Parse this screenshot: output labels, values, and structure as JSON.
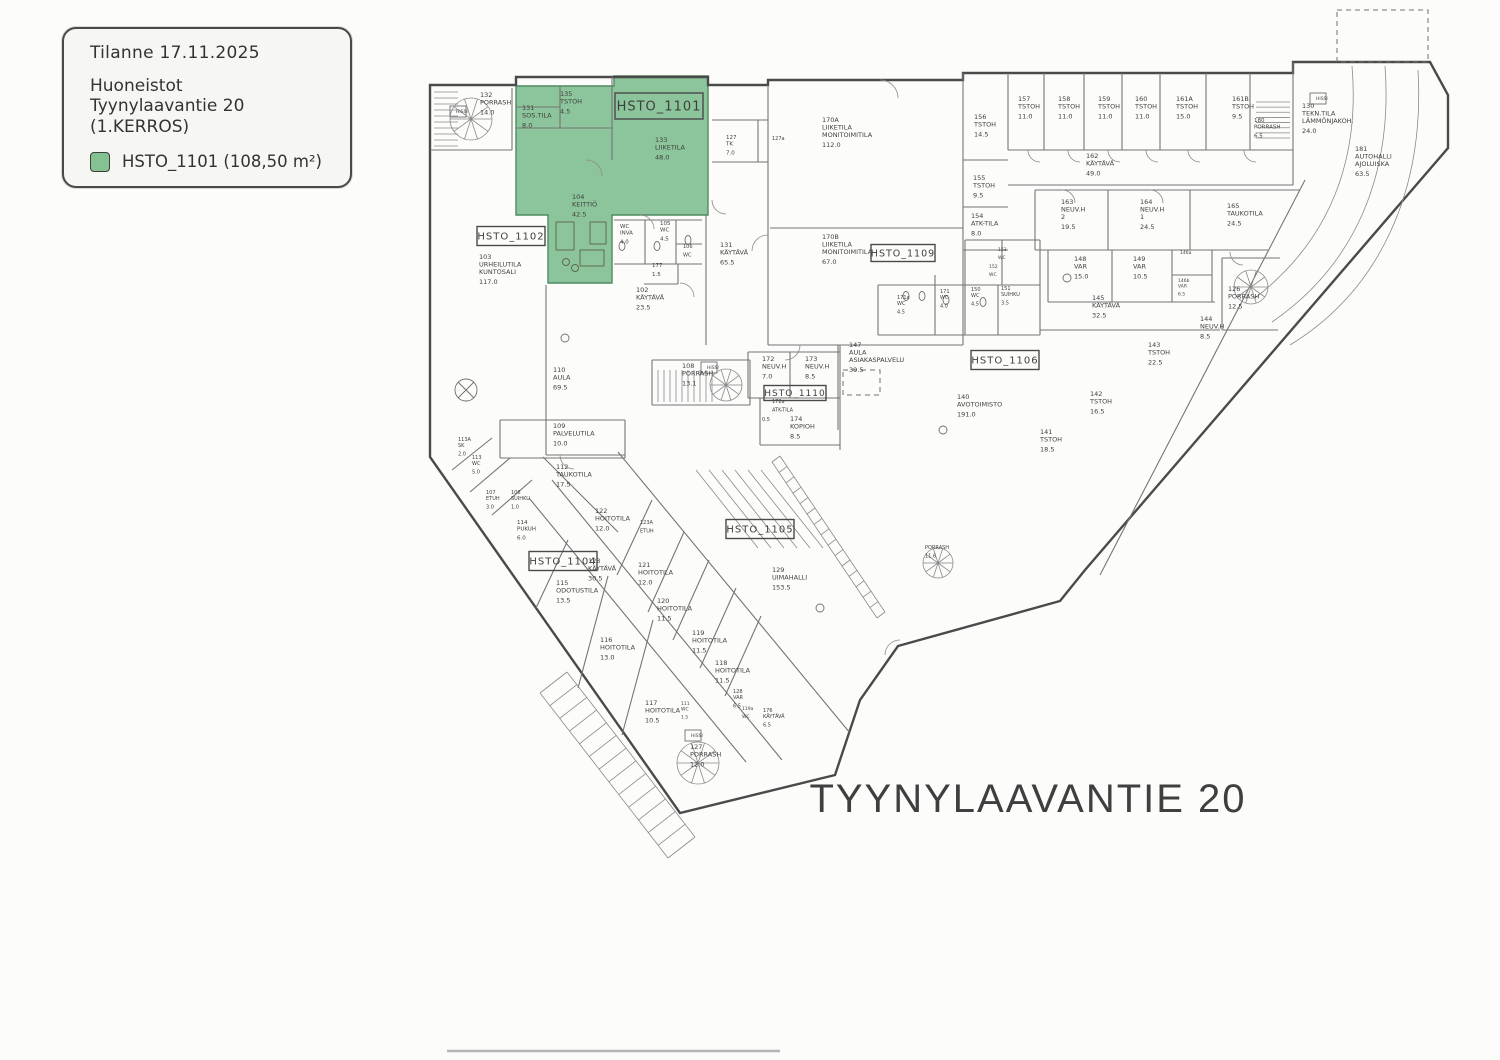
{
  "legend": {
    "line1": "Tilanne 17.11.2025",
    "line2": "Huoneistot",
    "line3": "Tyynylaavantie 20",
    "line4": "(1.KERROS)",
    "swatch_color": "#85c292",
    "swatch_label": "HSTO_1101 (108,50 m²)"
  },
  "street_label": "TYYNYLAAVANTIE 20",
  "highlight": {
    "color": "#8cc59b",
    "border": "#4f8a62",
    "label": "HSTO_1101"
  },
  "apartment_boxes": [
    {
      "label": "HSTO_1101",
      "x": 659,
      "y": 106,
      "w": 88,
      "h": 26,
      "fs": 13
    },
    {
      "label": "HSTO_1102",
      "x": 511,
      "y": 236,
      "w": 68,
      "h": 19,
      "fs": 10
    },
    {
      "label": "HSTO_1104",
      "x": 563,
      "y": 561,
      "w": 68,
      "h": 19,
      "fs": 10
    },
    {
      "label": "HSTO_1105",
      "x": 760,
      "y": 529,
      "w": 68,
      "h": 19,
      "fs": 10
    },
    {
      "label": "HSTO_1106",
      "x": 1005,
      "y": 360,
      "w": 68,
      "h": 19,
      "fs": 10
    },
    {
      "label": "HSTO_1109",
      "x": 903,
      "y": 253,
      "w": 64,
      "h": 17,
      "fs": 9.5
    },
    {
      "label": "HSTO_1110",
      "x": 795,
      "y": 393,
      "w": 62,
      "h": 15,
      "fs": 9
    }
  ],
  "rooms": [
    {
      "l": [
        "132",
        "PORRASH",
        "14.0"
      ],
      "x": 480,
      "y": 97
    },
    {
      "l": [
        "HISSI"
      ],
      "x": 456,
      "y": 113,
      "s": 4.5
    },
    {
      "l": [
        "135",
        "TSTOH",
        "4.5"
      ],
      "x": 560,
      "y": 96
    },
    {
      "l": [
        "131",
        "SOS.TILA",
        "8.0"
      ],
      "x": 522,
      "y": 110
    },
    {
      "l": [
        "133",
        "LIIKETILA",
        "48.0"
      ],
      "x": 655,
      "y": 142
    },
    {
      "l": [
        "104",
        "KEITTIÖ",
        "42.5"
      ],
      "x": 572,
      "y": 199
    },
    {
      "l": [
        "WC",
        "INVA",
        "4.0"
      ],
      "x": 620,
      "y": 228,
      "s": 5.5
    },
    {
      "l": [
        "105",
        "WC",
        "4.5"
      ],
      "x": 660,
      "y": 225,
      "s": 5.5
    },
    {
      "l": [
        "106",
        "WC"
      ],
      "x": 683,
      "y": 248,
      "s": 5
    },
    {
      "l": [
        "177",
        "1.5"
      ],
      "x": 652,
      "y": 267,
      "s": 5.5
    },
    {
      "l": [
        "102",
        "KÄYTÄVÄ",
        "23.5"
      ],
      "x": 636,
      "y": 292
    },
    {
      "l": [
        "131",
        "KÄYTÄVÄ",
        "65.5"
      ],
      "x": 720,
      "y": 247
    },
    {
      "l": [
        "127",
        "TK",
        "7.0"
      ],
      "x": 726,
      "y": 139,
      "s": 5.5
    },
    {
      "l": [
        "127a"
      ],
      "x": 772,
      "y": 140,
      "s": 5
    },
    {
      "l": [
        "103",
        "URHEILUTILA",
        "KUNTOSALI",
        "117.0"
      ],
      "x": 479,
      "y": 259
    },
    {
      "l": [
        "170A",
        "LIIKETILA",
        "MONITOIMITILA",
        "112.0"
      ],
      "x": 822,
      "y": 122
    },
    {
      "l": [
        "170B",
        "LIIKETILA",
        "MONITOIMITILA",
        "67.0"
      ],
      "x": 822,
      "y": 239
    },
    {
      "l": [
        "156",
        "TSTOH",
        "14.5"
      ],
      "x": 974,
      "y": 119
    },
    {
      "l": [
        "155",
        "TSTOH",
        "9.5"
      ],
      "x": 973,
      "y": 180
    },
    {
      "l": [
        "154",
        "ATK-TILA",
        "8.0"
      ],
      "x": 971,
      "y": 218
    },
    {
      "l": [
        "157",
        "TSTOH",
        "11.0"
      ],
      "x": 1018,
      "y": 101
    },
    {
      "l": [
        "158",
        "TSTOH",
        "11.0"
      ],
      "x": 1058,
      "y": 101
    },
    {
      "l": [
        "159",
        "TSTOH",
        "11.0"
      ],
      "x": 1098,
      "y": 101
    },
    {
      "l": [
        "160",
        "TSTOH",
        "11.0"
      ],
      "x": 1135,
      "y": 101
    },
    {
      "l": [
        "161A",
        "TSTOH",
        "15.0"
      ],
      "x": 1176,
      "y": 101
    },
    {
      "l": [
        "161B",
        "TSTOH",
        "9.5"
      ],
      "x": 1232,
      "y": 101
    },
    {
      "l": [
        "180",
        "PORRASH",
        "6.5"
      ],
      "x": 1254,
      "y": 122,
      "s": 5.5
    },
    {
      "l": [
        "HISSI"
      ],
      "x": 1316,
      "y": 100,
      "s": 4.5
    },
    {
      "l": [
        "162",
        "KÄYTÄVÄ",
        "49.0"
      ],
      "x": 1086,
      "y": 158
    },
    {
      "l": [
        "130",
        "TEKN.TILA",
        "LÄMMÖNJAKOH.",
        "24.0"
      ],
      "x": 1302,
      "y": 108
    },
    {
      "l": [
        "181",
        "AUTOHALLI",
        "AJOLUISKA",
        "63.5"
      ],
      "x": 1355,
      "y": 151
    },
    {
      "l": [
        "163",
        "NEUV.H",
        "2",
        "19.5"
      ],
      "x": 1061,
      "y": 204
    },
    {
      "l": [
        "164",
        "NEUV.H",
        "1",
        "24.5"
      ],
      "x": 1140,
      "y": 204
    },
    {
      "l": [
        "165",
        "TAUKOTILA",
        "24.5"
      ],
      "x": 1227,
      "y": 208
    },
    {
      "l": [
        "148",
        "VAR",
        "15.0"
      ],
      "x": 1074,
      "y": 261
    },
    {
      "l": [
        "149",
        "VAR",
        "10.5"
      ],
      "x": 1133,
      "y": 261
    },
    {
      "l": [
        "146a"
      ],
      "x": 1180,
      "y": 254,
      "s": 4.5
    },
    {
      "l": [
        "146b",
        "VAR",
        "6.5"
      ],
      "x": 1178,
      "y": 282,
      "s": 4.5
    },
    {
      "l": [
        "145",
        "KÄYTÄVÄ",
        "32.5"
      ],
      "x": 1092,
      "y": 300
    },
    {
      "l": [
        "126",
        "PORRASH",
        "12.5"
      ],
      "x": 1228,
      "y": 291
    },
    {
      "l": [
        "171a",
        "WC",
        "4.5"
      ],
      "x": 897,
      "y": 299,
      "s": 5
    },
    {
      "l": [
        "171",
        "WC",
        "4.0"
      ],
      "x": 940,
      "y": 293,
      "s": 5
    },
    {
      "l": [
        "150",
        "WC",
        "4.5"
      ],
      "x": 971,
      "y": 291,
      "s": 5
    },
    {
      "l": [
        "151",
        "SUIHKU",
        "3.5"
      ],
      "x": 1001,
      "y": 290,
      "s": 5
    },
    {
      "l": [
        "152",
        "WC"
      ],
      "x": 989,
      "y": 268,
      "s": 4.5
    },
    {
      "l": [
        "153",
        "WC"
      ],
      "x": 998,
      "y": 251,
      "s": 4.5
    },
    {
      "l": [
        "147",
        "AULA",
        "ASIAKASPALVELU",
        "39.5"
      ],
      "x": 849,
      "y": 347
    },
    {
      "l": [
        "108",
        "PORRASH",
        "13.1"
      ],
      "x": 682,
      "y": 368
    },
    {
      "l": [
        "HISSI"
      ],
      "x": 707,
      "y": 369,
      "s": 4.5
    },
    {
      "l": [
        "172",
        "NEUV.H",
        "7.0"
      ],
      "x": 762,
      "y": 361
    },
    {
      "l": [
        "173",
        "NEUV.H",
        "8.5"
      ],
      "x": 805,
      "y": 361
    },
    {
      "l": [
        "172a",
        "ATK-TILA"
      ],
      "x": 772,
      "y": 403,
      "s": 5
    },
    {
      "l": [
        "0.5"
      ],
      "x": 762,
      "y": 421,
      "s": 5
    },
    {
      "l": [
        "174",
        "KOPIOH",
        "8.5"
      ],
      "x": 790,
      "y": 421
    },
    {
      "l": [
        "110",
        "AULA",
        "69.5"
      ],
      "x": 553,
      "y": 372
    },
    {
      "l": [
        "109",
        "PALVELUTILA",
        "10.0"
      ],
      "x": 553,
      "y": 428
    },
    {
      "l": [
        "140",
        "AVOTOIMISTO",
        "191.0"
      ],
      "x": 957,
      "y": 399
    },
    {
      "l": [
        "141",
        "TSTOH",
        "18.5"
      ],
      "x": 1040,
      "y": 434
    },
    {
      "l": [
        "142",
        "TSTOH",
        "16.5"
      ],
      "x": 1090,
      "y": 396
    },
    {
      "l": [
        "143",
        "TSTOH",
        "22.5"
      ],
      "x": 1148,
      "y": 347
    },
    {
      "l": [
        "144",
        "NEUV.H",
        "8.5"
      ],
      "x": 1200,
      "y": 321
    },
    {
      "l": [
        "129",
        "UIMAHALLI",
        "153.5"
      ],
      "x": 772,
      "y": 572
    },
    {
      "l": [
        "PORRASH",
        "11.6"
      ],
      "x": 925,
      "y": 549,
      "s": 5
    },
    {
      "l": [
        "113A",
        "SK",
        "2.0"
      ],
      "x": 458,
      "y": 441,
      "s": 5
    },
    {
      "l": [
        "113",
        "WC",
        "5.0"
      ],
      "x": 472,
      "y": 459,
      "s": 5
    },
    {
      "l": [
        "107",
        "ETUH",
        "3.0"
      ],
      "x": 486,
      "y": 494,
      "s": 5
    },
    {
      "l": [
        "106",
        "SUIHKU",
        "1.0"
      ],
      "x": 511,
      "y": 494,
      "s": 5
    },
    {
      "l": [
        "114",
        "PUKUH",
        "6.0"
      ],
      "x": 517,
      "y": 524,
      "s": 5.5
    },
    {
      "l": [
        "112",
        "TAUKOTILA",
        "17.5"
      ],
      "x": 556,
      "y": 469
    },
    {
      "l": [
        "122",
        "HOITOTILA",
        "12.0"
      ],
      "x": 595,
      "y": 513
    },
    {
      "l": [
        "123A",
        "ETUH"
      ],
      "x": 640,
      "y": 524,
      "s": 5
    },
    {
      "l": [
        "121",
        "HOITOTILA",
        "12.0"
      ],
      "x": 638,
      "y": 567
    },
    {
      "l": [
        "120",
        "HOITOTILA",
        "11.5"
      ],
      "x": 657,
      "y": 603
    },
    {
      "l": [
        "115",
        "ODOTUSTILA",
        "13.5"
      ],
      "x": 556,
      "y": 585
    },
    {
      "l": [
        "128",
        "KÄYTÄVÄ",
        "30.5"
      ],
      "x": 588,
      "y": 563
    },
    {
      "l": [
        "116",
        "HOITOTILA",
        "13.0"
      ],
      "x": 600,
      "y": 642
    },
    {
      "l": [
        "119",
        "HOITOTILA",
        "11.5"
      ],
      "x": 692,
      "y": 635
    },
    {
      "l": [
        "118",
        "HOITOTILA",
        "11.5"
      ],
      "x": 715,
      "y": 665
    },
    {
      "l": [
        "117",
        "HOITOTILA",
        "10.5"
      ],
      "x": 645,
      "y": 705
    },
    {
      "l": [
        "111",
        "WC",
        "1.5"
      ],
      "x": 681,
      "y": 705,
      "s": 4.5
    },
    {
      "l": [
        "119a",
        "WC"
      ],
      "x": 742,
      "y": 710,
      "s": 4.5
    },
    {
      "l": [
        "128",
        "VAR",
        "6.5"
      ],
      "x": 733,
      "y": 693,
      "s": 5
    },
    {
      "l": [
        "176",
        "KÄYTÄVÄ",
        "6.5"
      ],
      "x": 763,
      "y": 712,
      "s": 5
    },
    {
      "l": [
        "127",
        "PORRASH",
        "12.0"
      ],
      "x": 690,
      "y": 749
    },
    {
      "l": [
        "HISSI"
      ],
      "x": 691,
      "y": 737,
      "s": 4.5
    }
  ]
}
